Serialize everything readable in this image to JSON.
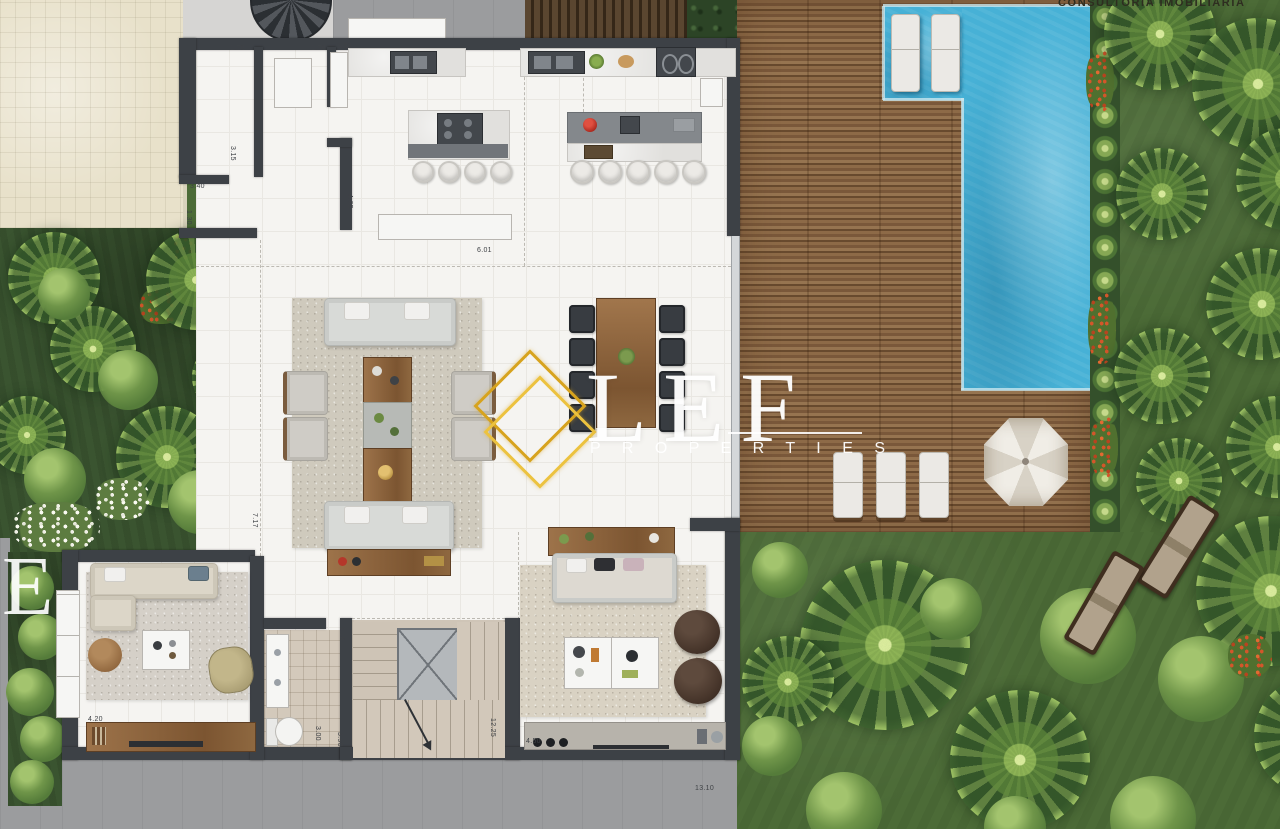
{
  "header": {
    "consultancy_text": "CONSULTORIA IMOBILIÁRIA"
  },
  "watermark": {
    "letters": "LEF",
    "tagline": "P R O P E R T I E S",
    "partial_letter": "E",
    "gold_color": "#d7a31e",
    "text_color": "#ffffff"
  },
  "colors": {
    "wall": "#3d4146",
    "floor": "#f5f4f1",
    "pool_water": "#47b1d6",
    "deck_wood": "#7a583a",
    "lawn": "#4c6b37",
    "garden_dark": "#3a5430",
    "paving": "#e8e1ca",
    "concrete": "#9b9c9e",
    "rug": "#cfcabd",
    "furniture_wood": "#8b6743"
  },
  "dimension_labels": [
    {
      "text": "1.70",
      "x": 230,
      "y": 45,
      "rot": 0
    },
    {
      "text": "1.70",
      "x": 311,
      "y": 45,
      "rot": 0
    },
    {
      "text": "3.90",
      "x": 337,
      "y": 43,
      "rot": 0
    },
    {
      "text": "3.15",
      "x": 236,
      "y": 146,
      "rot": 1
    },
    {
      "text": "3.15",
      "x": 262,
      "y": 146,
      "rot": 1
    },
    {
      "text": "3.40",
      "x": 190,
      "y": 183,
      "rot": 0
    },
    {
      "text": "1.30",
      "x": 192,
      "y": 210,
      "rot": 1
    },
    {
      "text": "4.65",
      "x": 353,
      "y": 194,
      "rot": 1
    },
    {
      "text": "6.01",
      "x": 477,
      "y": 247,
      "rot": 0
    },
    {
      "text": "7.17",
      "x": 258,
      "y": 513,
      "rot": 1
    },
    {
      "text": "4.20",
      "x": 88,
      "y": 716,
      "rot": 0
    },
    {
      "text": "1.78",
      "x": 263,
      "y": 624,
      "rot": 0
    },
    {
      "text": "3.18",
      "x": 345,
      "y": 626,
      "rot": 1
    },
    {
      "text": "3.00",
      "x": 321,
      "y": 726,
      "rot": 1
    },
    {
      "text": "3.90",
      "x": 343,
      "y": 732,
      "rot": 1
    },
    {
      "text": "12.25",
      "x": 496,
      "y": 718,
      "rot": 1
    },
    {
      "text": "4.50",
      "x": 526,
      "y": 738,
      "rot": 0
    },
    {
      "text": "13.10",
      "x": 695,
      "y": 785,
      "rot": 0
    }
  ]
}
